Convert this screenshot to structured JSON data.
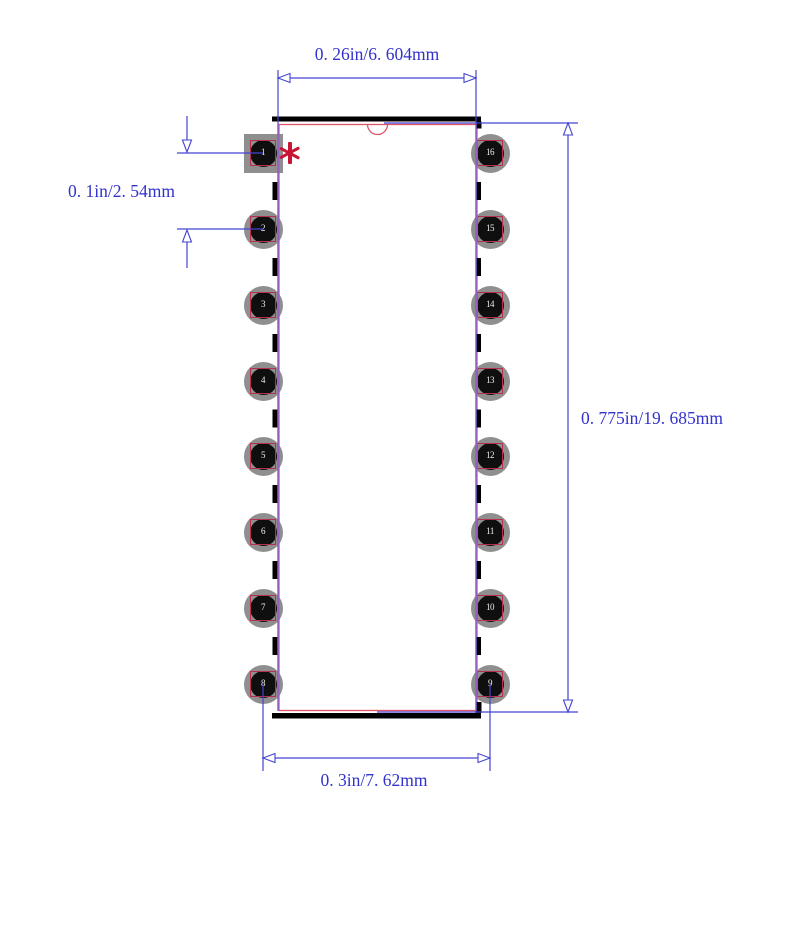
{
  "figure": {
    "dimension_labels": {
      "top": "0. 26in/6. 604mm",
      "left": "0. 1in/2. 54mm",
      "right": "0. 775in/19. 685mm",
      "bottom": "0. 3in/7. 62mm"
    },
    "pins": {
      "left": [
        "1",
        "2",
        "3",
        "4",
        "5",
        "6",
        "7",
        "8"
      ],
      "right": [
        "16",
        "15",
        "14",
        "13",
        "12",
        "11",
        "10",
        "9"
      ]
    },
    "pin1_marker_icon": "asterisk",
    "pin1_pad_shape": "square",
    "colors": {
      "dimension_blue": "#4444d2",
      "label_blue": "#3232cd",
      "extension_purple": "#8161de",
      "outline_red": "#dd5566",
      "pad_frame_red": "#b5304a",
      "marker_red": "#c81535",
      "pad_gray": "#8f8f8f",
      "hole_black": "#0f0f0f",
      "body_black": "#000000",
      "background": "#ffffff"
    }
  }
}
